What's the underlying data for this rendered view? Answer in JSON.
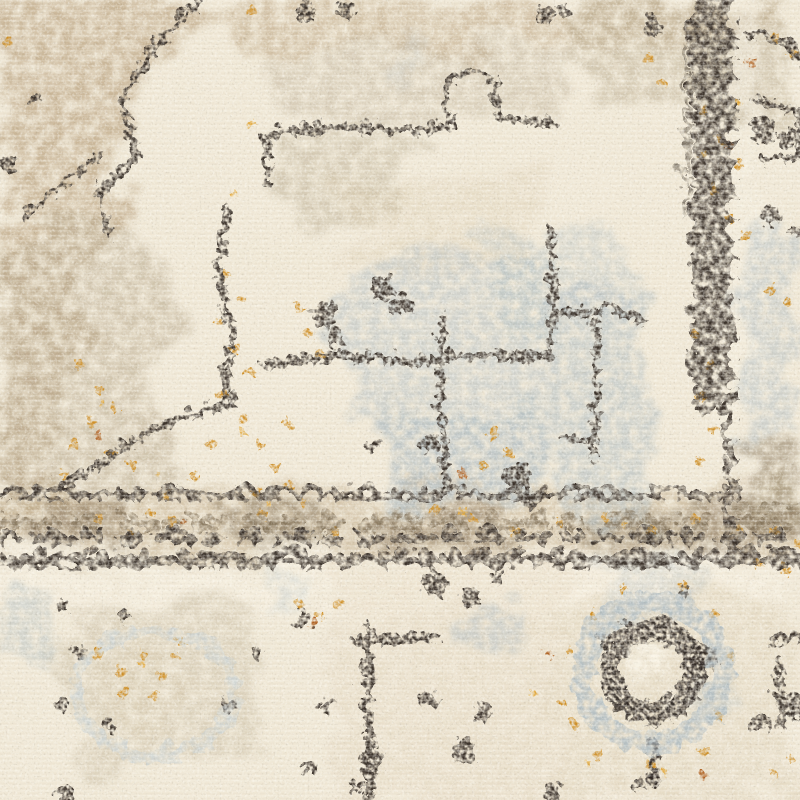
{
  "image": {
    "kind": "photograph",
    "subject": "Close-up detail of a distressed vintage-style oriental area rug pile",
    "aria_label": "Close-up photo of a cream, beige, gray and charcoal distressed oriental rug with scattered gold flecks: a faded tan medallion corner at upper left, thin eroded charcoal motif outlines on a cream ground, slate blue-gray faded patches in the center, a speckled charcoal and brown border band running across the middle with a vertical border stripe on the right, a ghosted floral medallion at lower left and a circular rosette with a dark core ring at lower right",
    "visible_text": "none",
    "palette": {
      "cream": "#f0e8d6",
      "light_cream": "#f8f2e3",
      "tan": "#c7b394",
      "taupe": "#b9ab90",
      "beige": "#d9cbaf",
      "band_beige": "#c3ad8d",
      "blue_gray": "#b2bec3",
      "light_blue_gray": "#c9d2d4",
      "brown": "#8d7b61",
      "guard_brown": "#7e6d54",
      "dark_brown": "#3a3329",
      "espresso": "#2d2820",
      "gold": "#cf8f25",
      "amber": "#e2a83b",
      "rust": "#b06224"
    },
    "motifs": [
      {
        "id": "tan-field-upper-left",
        "desc": "Faded tan and taupe corner of a large medallion field"
      },
      {
        "id": "charcoal-outlines",
        "desc": "Thin eroded charcoal geometric motif outlines"
      },
      {
        "id": "dark-speckle-blobs",
        "desc": "Scattered eroded charcoal speckle blobs"
      },
      {
        "id": "blue-gray-patches",
        "desc": "Faded slate blue-gray pile patches"
      },
      {
        "id": "gold-flecks",
        "desc": "Scattered gold, amber and rust flecks"
      },
      {
        "id": "border-band",
        "desc": "Speckled charcoal and brown border band with vertical border stripe"
      },
      {
        "id": "floral-medallion-bottom-left",
        "desc": "Ghosted floral medallion outline with gold center flecks"
      },
      {
        "id": "rosette-bottom-right",
        "desc": "Circular rosette with slate ring, espresso core ring and cream center"
      },
      {
        "id": "bottom-key-motif",
        "desc": "Broken charcoal key motif in the lower field"
      }
    ]
  }
}
